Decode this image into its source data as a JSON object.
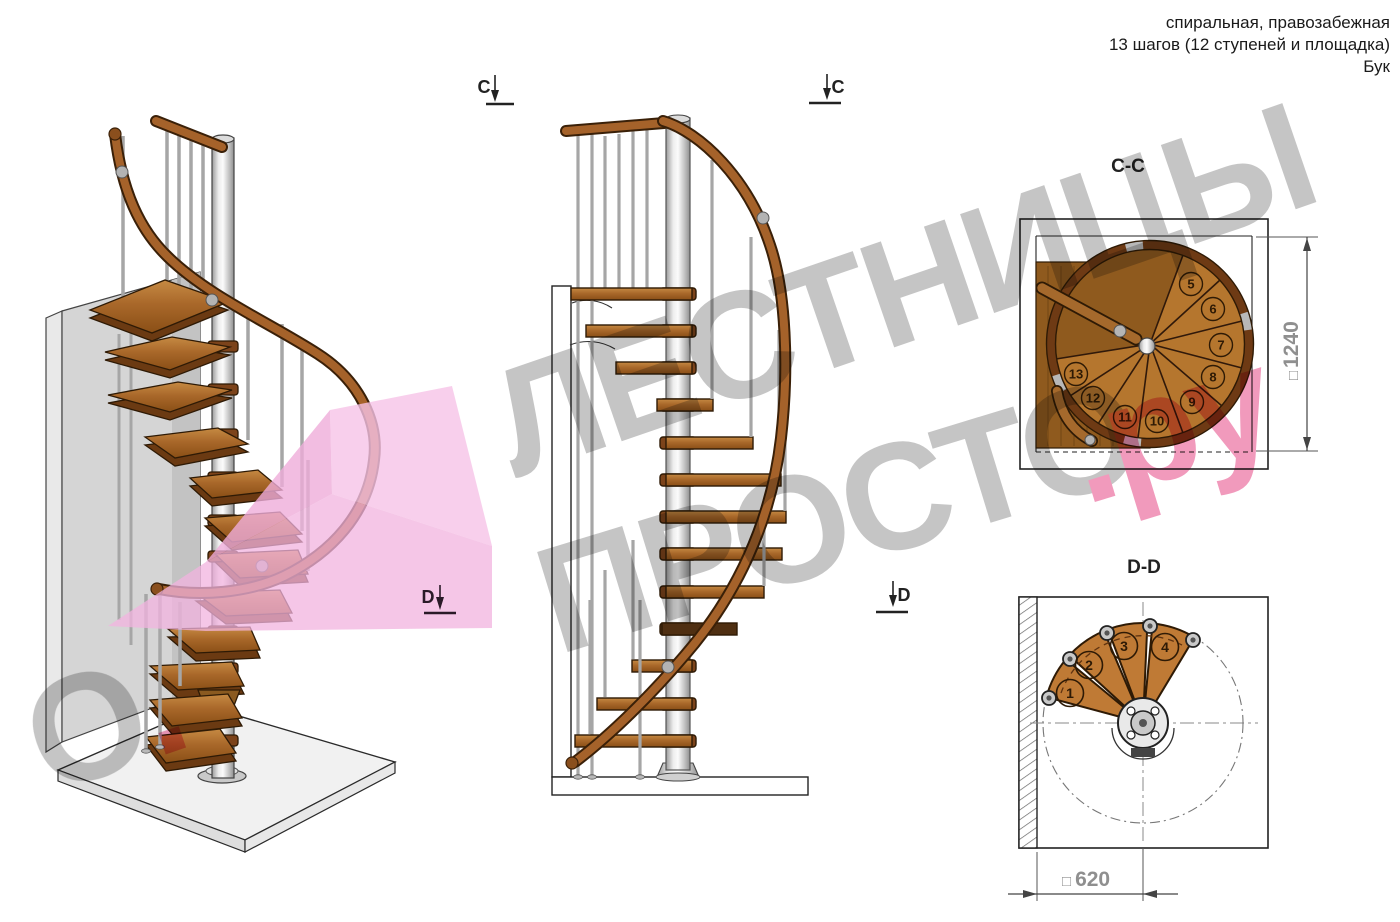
{
  "header": {
    "lines": [
      "спиральная, правозабежная",
      "13 шагов (12 ступеней и площадка)",
      "Бук"
    ]
  },
  "section_markers": {
    "c_label": "C",
    "d_label": "D"
  },
  "plan_cc": {
    "title": "C-C",
    "square_symbol": "□",
    "dimension_value": "1240",
    "step_numbers": [
      "5",
      "6",
      "7",
      "8",
      "9",
      "10",
      "11",
      "12",
      "13"
    ]
  },
  "plan_dd": {
    "title": "D-D",
    "square_symbol": "□",
    "dimension_value": "620",
    "step_numbers": [
      "1",
      "2",
      "3",
      "4"
    ]
  },
  "watermark": {
    "line1": "ЛЕСТНИЦЫ",
    "line2": "ПРОСТО",
    "line2_suffix": ".ру",
    "fragment_o": "О",
    "fragment_dot": ".",
    "gray_color": "#8a8a8a",
    "pink_color": "#e23377"
  },
  "colors": {
    "wood": "#a9682a",
    "wood_dark": "#6b3a12",
    "wood_rim": "#6e3a14",
    "outline": "#222222",
    "metal": "#c0c0c0",
    "wall": "#d5d5d5",
    "floor": "#f1f1f1",
    "pink_plane": "#f2b3df",
    "dimension_text": "#8f8f8f"
  }
}
